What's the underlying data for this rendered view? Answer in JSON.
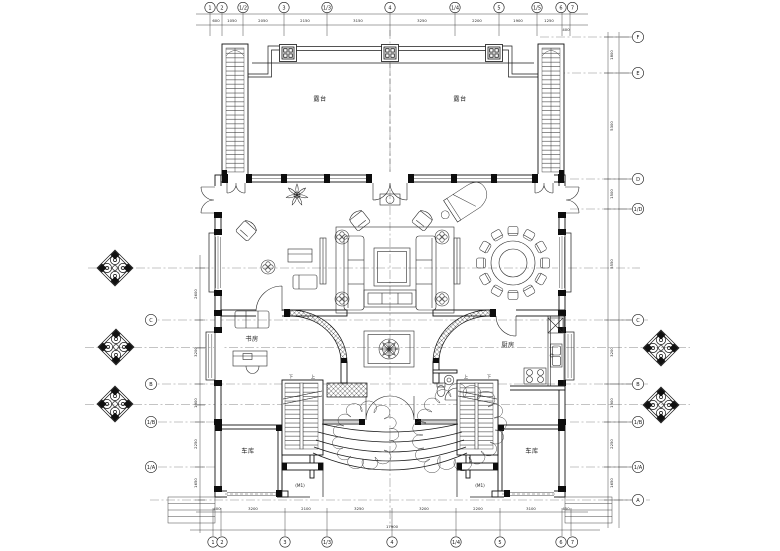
{
  "labels": {
    "terrace": "露台",
    "study": "书房",
    "kitchen": "厨房",
    "garage": "车库",
    "up": "上",
    "down": "下",
    "door_tag": "(M1)"
  },
  "grid": {
    "top": [
      "1",
      "2",
      "1/2",
      "3",
      "1/3",
      "4",
      "1/4",
      "5",
      "1/5",
      "6",
      "7"
    ],
    "bottom": [
      "1",
      "2",
      "3",
      "1/3",
      "4",
      "1/4",
      "5",
      "6",
      "7"
    ],
    "right": [
      "F",
      "E",
      "D",
      "1/D",
      "C",
      "B",
      "1/B",
      "1/A",
      "A"
    ],
    "left": [
      "C",
      "B",
      "1/B",
      "1/A"
    ]
  },
  "dims": {
    "top": [
      "600",
      "1050",
      "2050",
      "2150",
      "3150",
      "3250",
      "2200",
      "1900",
      "1250",
      "400"
    ],
    "bottom": [
      "400",
      "3200",
      "2100",
      "3250",
      "3200",
      "2200",
      "3100",
      "450"
    ],
    "bottom_total": "17900",
    "right": [
      "1800",
      "5300",
      "1500",
      "5550",
      "3200",
      "1900",
      "2250",
      "1650"
    ],
    "left": [
      "2600",
      "3200",
      "1900",
      "2250",
      "1650"
    ]
  }
}
